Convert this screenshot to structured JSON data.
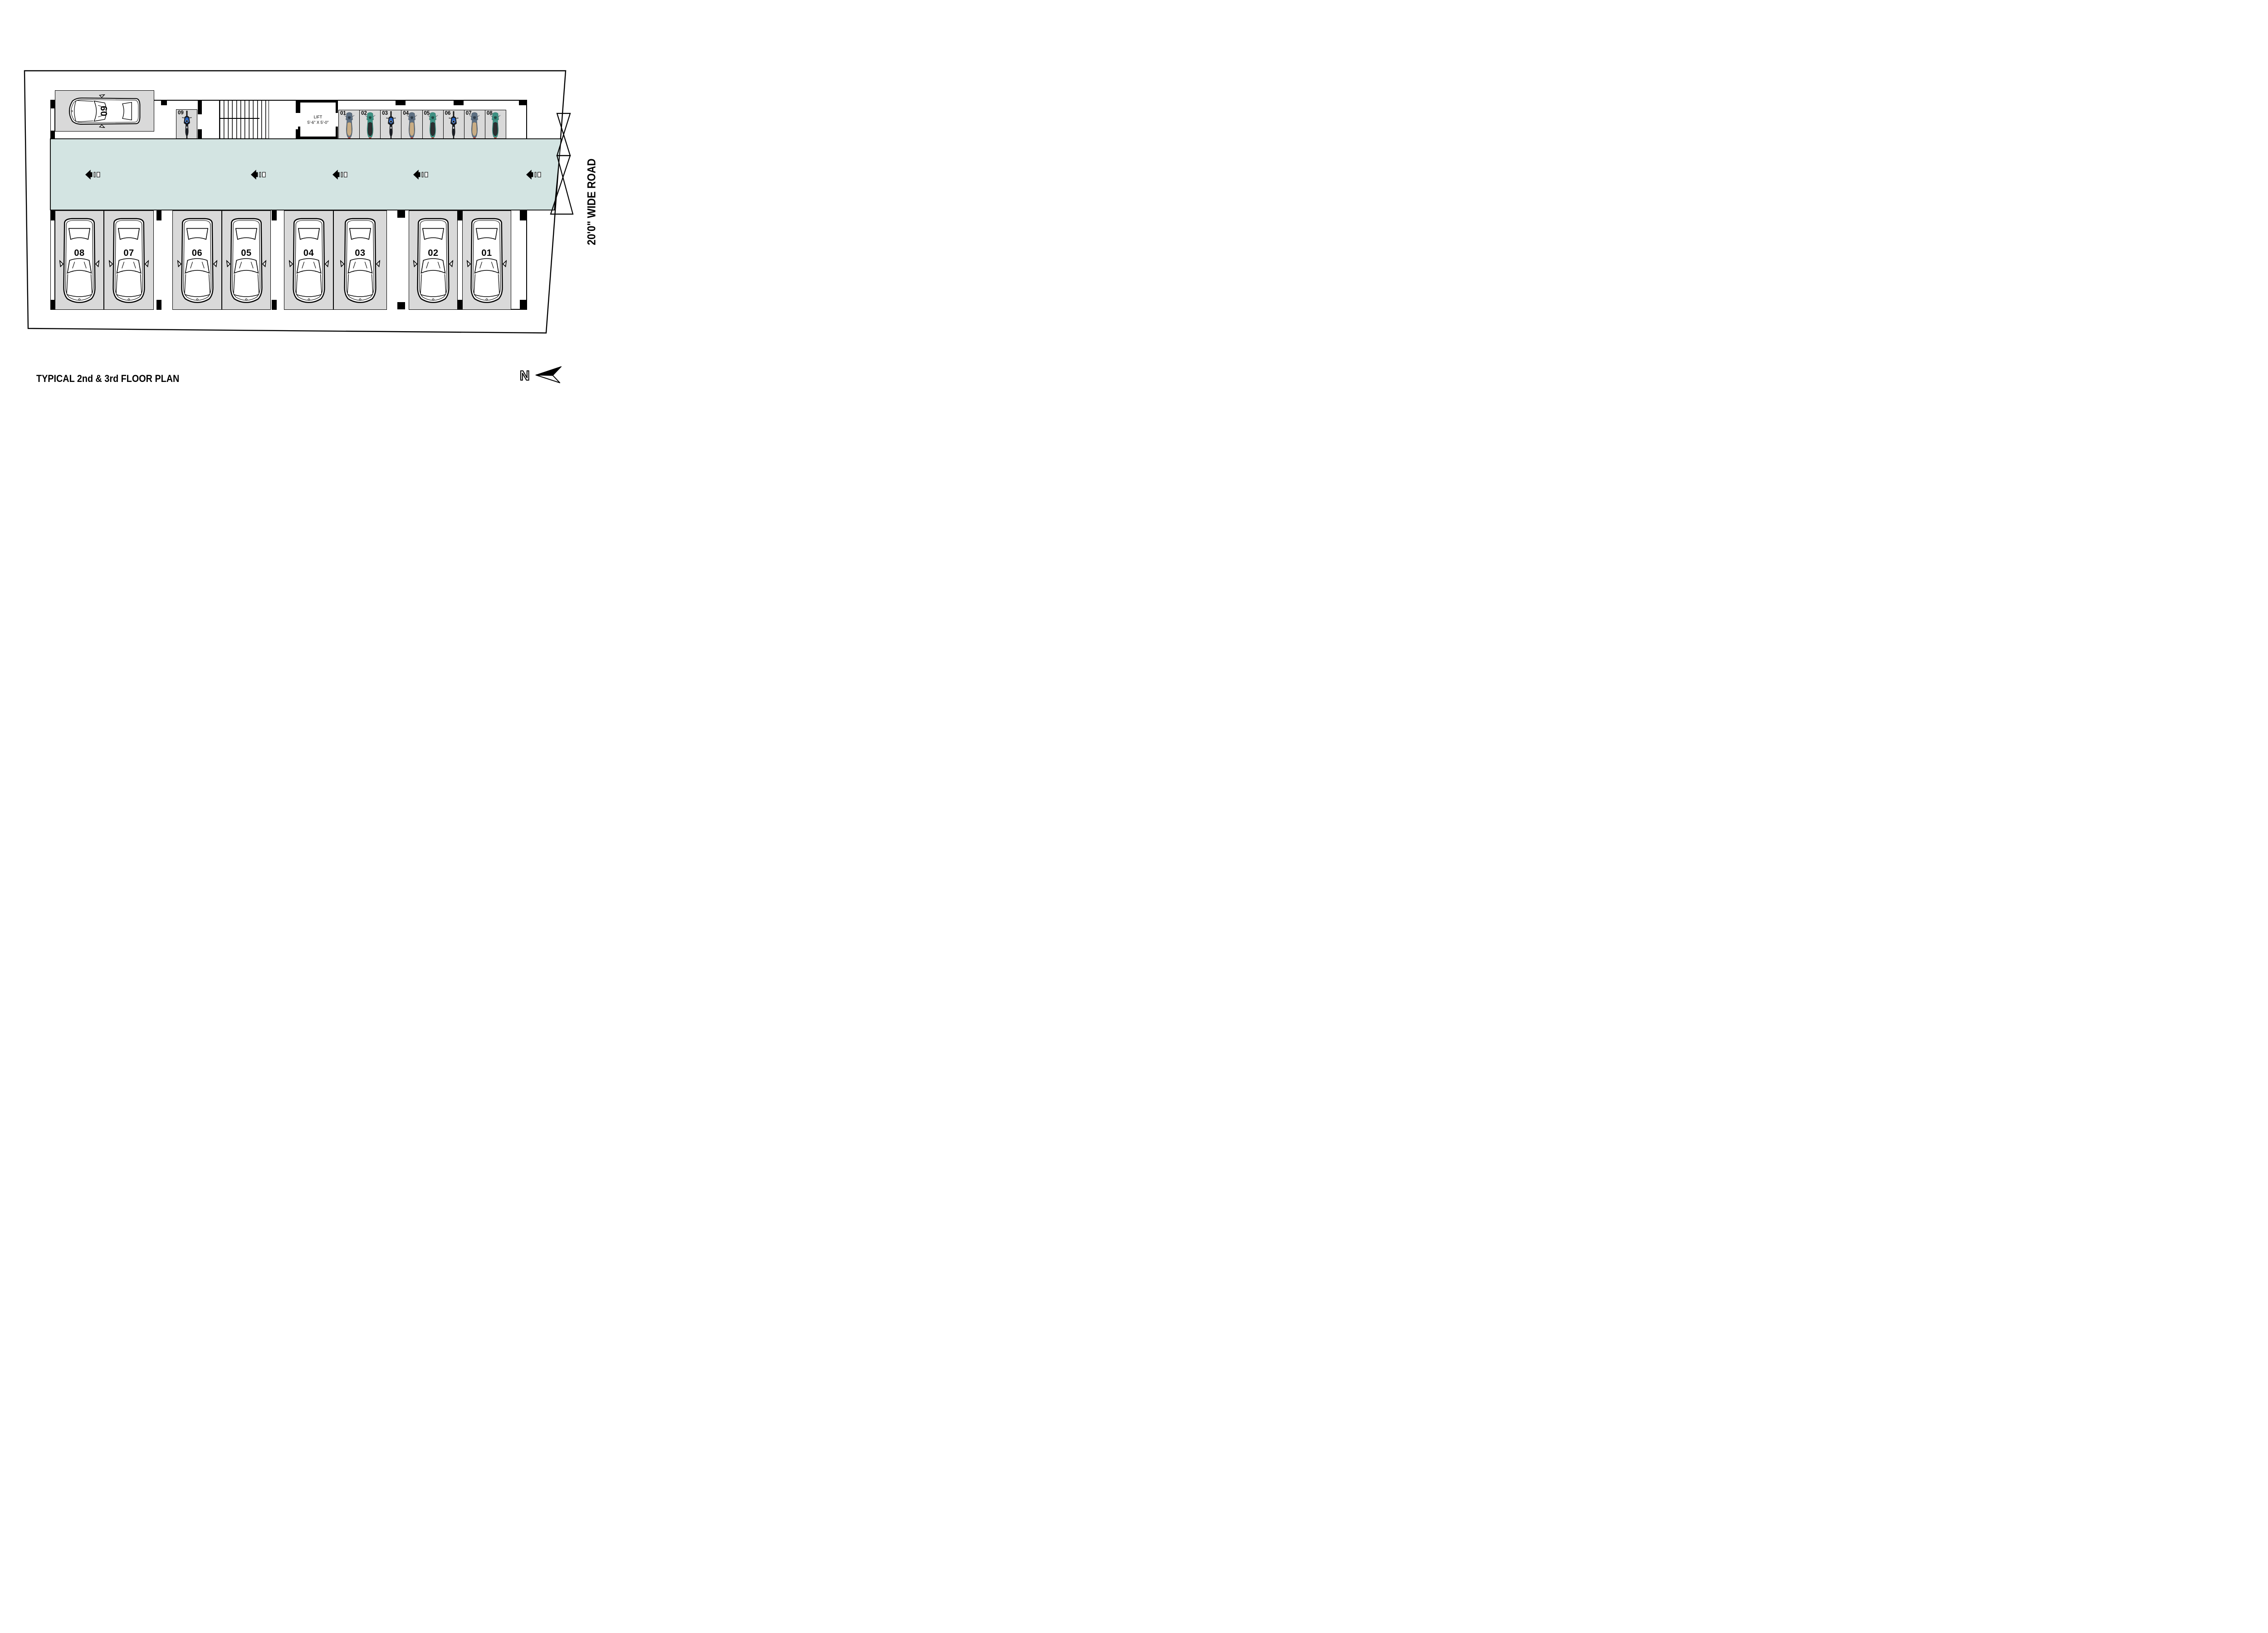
{
  "page": {
    "title": "TYPICAL 2nd & 3rd FLOOR PLAN"
  },
  "road": {
    "label": "20'0\" WIDE ROAD"
  },
  "north": {
    "label": "N",
    "icon": "north-arrow-icon"
  },
  "lift": {
    "label": "LIFT",
    "dimensions": "5'-6\" X 5'-0\""
  },
  "car_parking": {
    "row_stalls": [
      {
        "number": "08"
      },
      {
        "number": "07"
      },
      {
        "number": "06"
      },
      {
        "number": "05"
      },
      {
        "number": "04"
      },
      {
        "number": "03"
      },
      {
        "number": "02"
      },
      {
        "number": "01"
      }
    ],
    "corner_stall": {
      "number": "09"
    }
  },
  "bike_parking": {
    "stalls": [
      {
        "number": "01",
        "vehicle": "scooter-blue"
      },
      {
        "number": "02",
        "vehicle": "scooter-teal"
      },
      {
        "number": "03",
        "vehicle": "motorcycle"
      },
      {
        "number": "04",
        "vehicle": "scooter-blue"
      },
      {
        "number": "05",
        "vehicle": "scooter-teal"
      },
      {
        "number": "06",
        "vehicle": "motorcycle"
      },
      {
        "number": "07",
        "vehicle": "scooter-blue"
      },
      {
        "number": "08",
        "vehicle": "scooter-teal"
      }
    ],
    "corner_stall": {
      "number": "09",
      "vehicle": "motorcycle"
    }
  },
  "driveway": {
    "direction_arrow_icon": "left-direction-arrow-icon",
    "direction_arrow_count": 5,
    "gate_icon": "gate-crossing-icon"
  },
  "colors": {
    "driveway": "#d3e4e2",
    "stall_fill": "#d9d9d9",
    "line": "#000000",
    "scooter_blue": "#5e7083",
    "scooter_teal": "#3e9183",
    "motorcycle_dark": "#17181c"
  }
}
